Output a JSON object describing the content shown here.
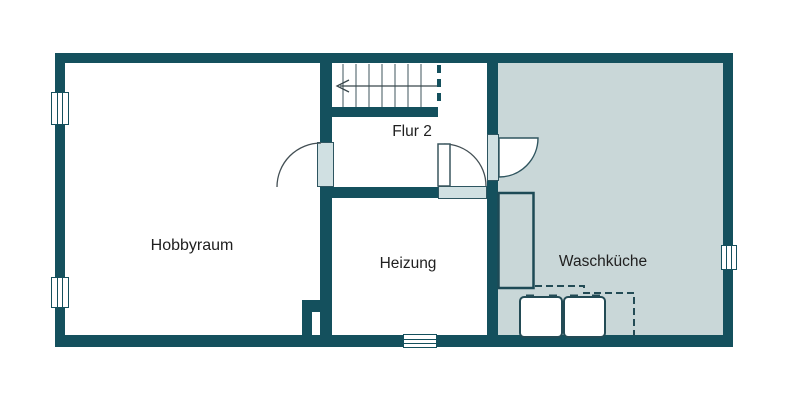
{
  "floor_plan": {
    "rooms": [
      {
        "label": "Hobbyraum"
      },
      {
        "label": "Flur 2"
      },
      {
        "label": "Heizung"
      },
      {
        "label": "Waschküche"
      }
    ],
    "colors": {
      "wall": "#14505d",
      "waschkueche_floor": "#c9d7d8",
      "door_opening_fill": "#d0e0e2",
      "background": "#ffffff",
      "text": "#202020"
    }
  }
}
